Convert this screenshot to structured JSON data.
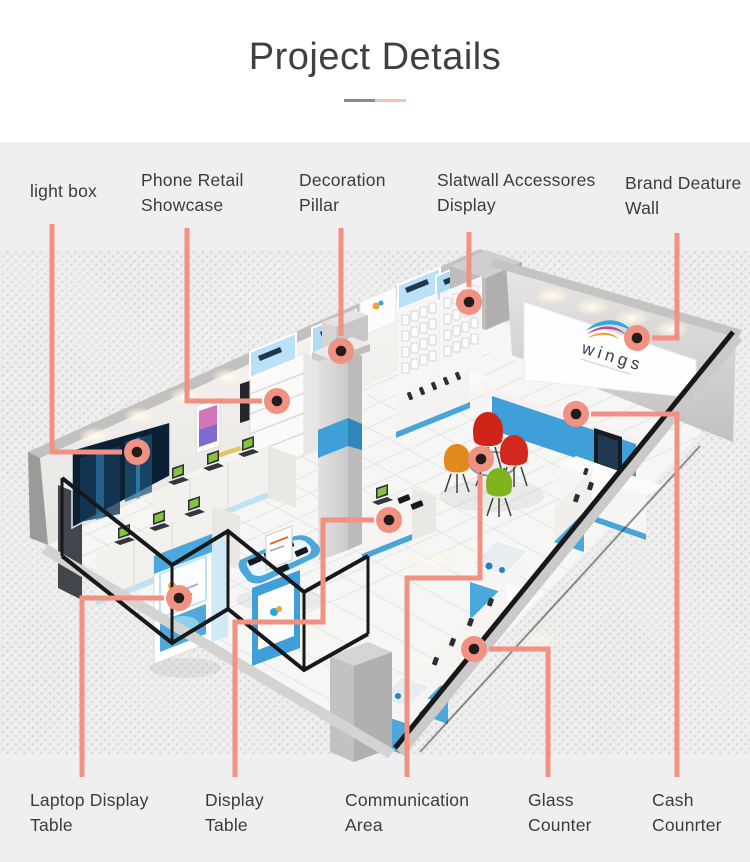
{
  "title": "Project Details",
  "brand": {
    "logo_text": "wings"
  },
  "callouts": {
    "top": [
      {
        "id": "light-box",
        "label": "light box"
      },
      {
        "id": "phone-retail-showcase",
        "label": "Phone Retail\nShowcase"
      },
      {
        "id": "decoration-pillar",
        "label": "Decoration\nPillar"
      },
      {
        "id": "slatwall-accessories-display",
        "label": "Slatwall Accessores\nDisplay"
      },
      {
        "id": "brand-feature-wall",
        "label": "Brand Deature\nWall"
      }
    ],
    "bottom": [
      {
        "id": "laptop-display-table",
        "label": "Laptop Display\nTable"
      },
      {
        "id": "display-table",
        "label": "Display\nTable"
      },
      {
        "id": "communication-area",
        "label": "Communication\nArea"
      },
      {
        "id": "glass-counter",
        "label": "Glass\nCounter"
      },
      {
        "id": "cash-counter",
        "label": "Cash\nCounrter"
      }
    ]
  },
  "colors": {
    "leader_salmon": "#F09181",
    "dot_center": "#231C1C",
    "divider_gray": "#8A8A8A",
    "divider_salmon": "#F2C3B3",
    "store_blue": "#3E9FD9",
    "sign_lightblue": "#B9E2F6",
    "panel_bg": "#EFEFEF",
    "chair_red": "#CF2418",
    "chair_orange": "#E2891B",
    "chair_green": "#7FB31F"
  }
}
